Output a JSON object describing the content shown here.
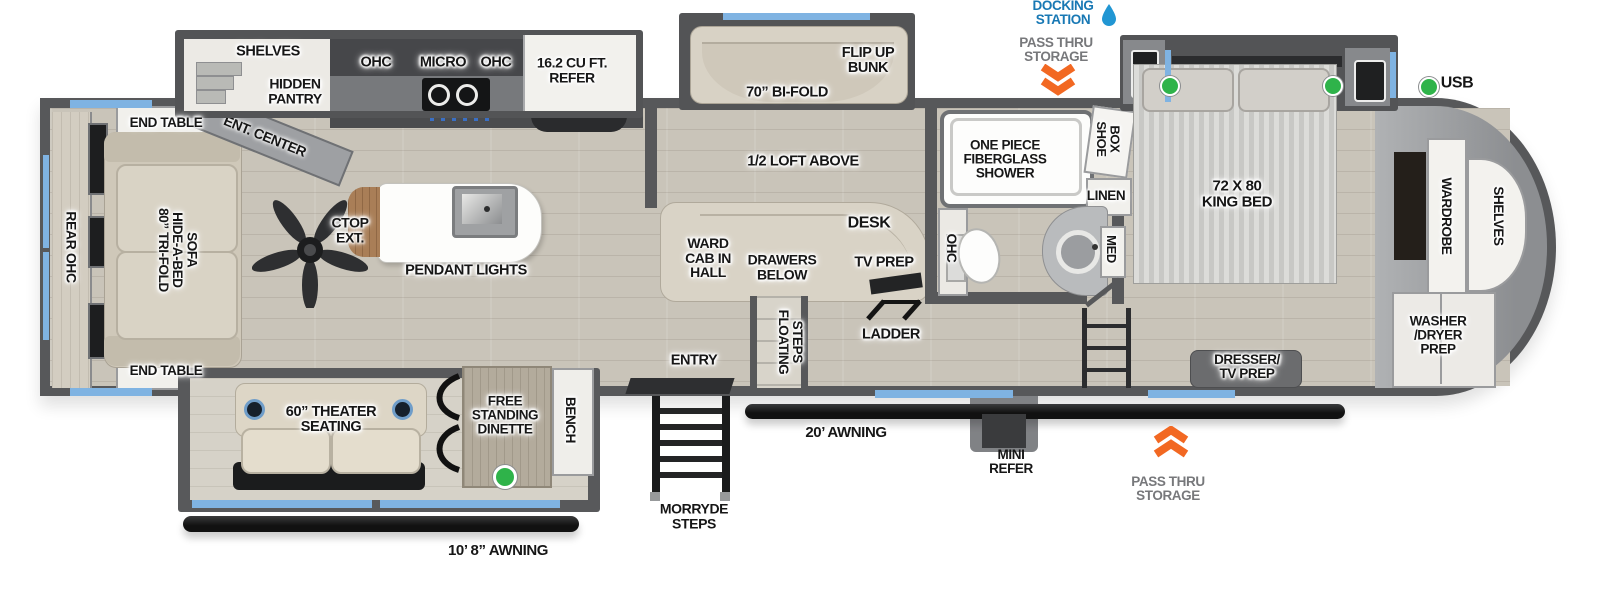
{
  "colors": {
    "wall": "#57585a",
    "floor": "#c9c4b9",
    "window_blue": "#7fb3e2",
    "docking_blue": "#1878b4",
    "arrow_orange": "#f26822",
    "usb_green": "#2fb34a"
  },
  "labels": {
    "kitchen": {
      "shelves": "SHELVES",
      "hidden_pantry": "HIDDEN\nPANTRY",
      "ent_center": "ENT. CENTER",
      "ohc_left": "OHC",
      "micro": "MICRO",
      "ohc_right": "OHC",
      "refer": "16.2 CU FT.\nREFER",
      "ctop_ext": "CTOP\nEXT.",
      "pendant_lights": "PENDANT LIGHTS"
    },
    "living": {
      "end_table_top": "END TABLE",
      "end_table_bottom": "END TABLE",
      "rear_ohc": "REAR OHC",
      "sofa": "80” TRI-FOLD\nHIDE-A-BED\nSOFA",
      "theater": "60” THEATER\nSEATING",
      "dinette": "FREE\nSTANDING\nDINETTE",
      "bench": "BENCH"
    },
    "loft": {
      "flip_up_bunk": "FLIP UP\nBUNK",
      "bifold": "70” BI-FOLD",
      "half_loft": "1/2 LOFT ABOVE",
      "ward_cab": "WARD\nCAB IN\nHALL",
      "drawers_below": "DRAWERS\nBELOW",
      "desk": "DESK",
      "tv_prep": "TV PREP",
      "floating_steps": "FLOATING\nSTEPS",
      "ladder": "LADDER",
      "entry": "ENTRY"
    },
    "bath": {
      "shower": "ONE PIECE\nFIBERGLASS\nSHOWER",
      "shoe_box": "SHOE\nBOX",
      "linen": "LINEN",
      "ohc": "OHC",
      "med": "MED"
    },
    "bedroom": {
      "king_bed": "72 X 80\nKING BED",
      "usb": "USB",
      "wardrobe": "WARDROBE",
      "shelves": "SHELVES",
      "washer_dryer": "WASHER\n/DRYER\nPREP",
      "dresser": "DRESSER/\nTV PREP"
    },
    "exterior": {
      "docking": "DOCKING\nSTATION",
      "pass_thru_top": "PASS THRU\nSTORAGE",
      "pass_thru_bottom": "PASS THRU\nSTORAGE",
      "awning_20": "20’ AWNING",
      "awning_10_8": "10’ 8” AWNING",
      "morryde": "MORRYDE\nSTEPS",
      "mini_refer": "MINI\nREFER"
    }
  }
}
